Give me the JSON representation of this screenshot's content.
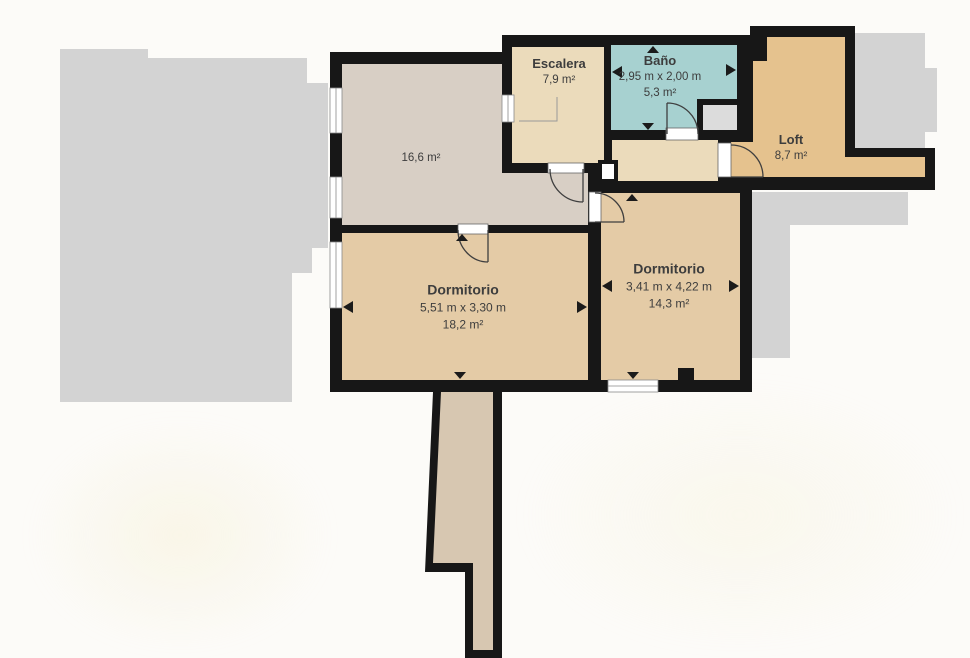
{
  "plan": {
    "rooms": {
      "living": {
        "area": "16,6 m²"
      },
      "stairs": {
        "name": "Escalera",
        "area": "7,9 m²"
      },
      "bathroom": {
        "name": "Baño",
        "dimensions": "2,95 m x 2,00 m",
        "area": "5,3 m²"
      },
      "loft": {
        "name": "Loft",
        "area": "8,7 m²"
      },
      "bedroom1": {
        "name": "Dormitorio",
        "dimensions": "5,51 m x 3,30 m",
        "area": "18,2 m²"
      },
      "bedroom2": {
        "name": "Dormitorio",
        "dimensions": "3,41 m x 4,22 m",
        "area": "14,3 m²"
      }
    },
    "colors": {
      "wall": "#171717",
      "living": "#d8cfc5",
      "stairs_hall": "#ebdbbb",
      "bathroom": "#a7d1d0",
      "loft": "#e5c28e",
      "bedroom": "#e4cba6",
      "corridor": "#d7c7b1",
      "adjacent_gray": "#d3d3d3",
      "shower": "#dcdcdc",
      "window_line": "#8a8a8a",
      "door_arc": "#3f3f3f",
      "text": "#3d3d3d",
      "background": "#fcfbf8"
    }
  }
}
